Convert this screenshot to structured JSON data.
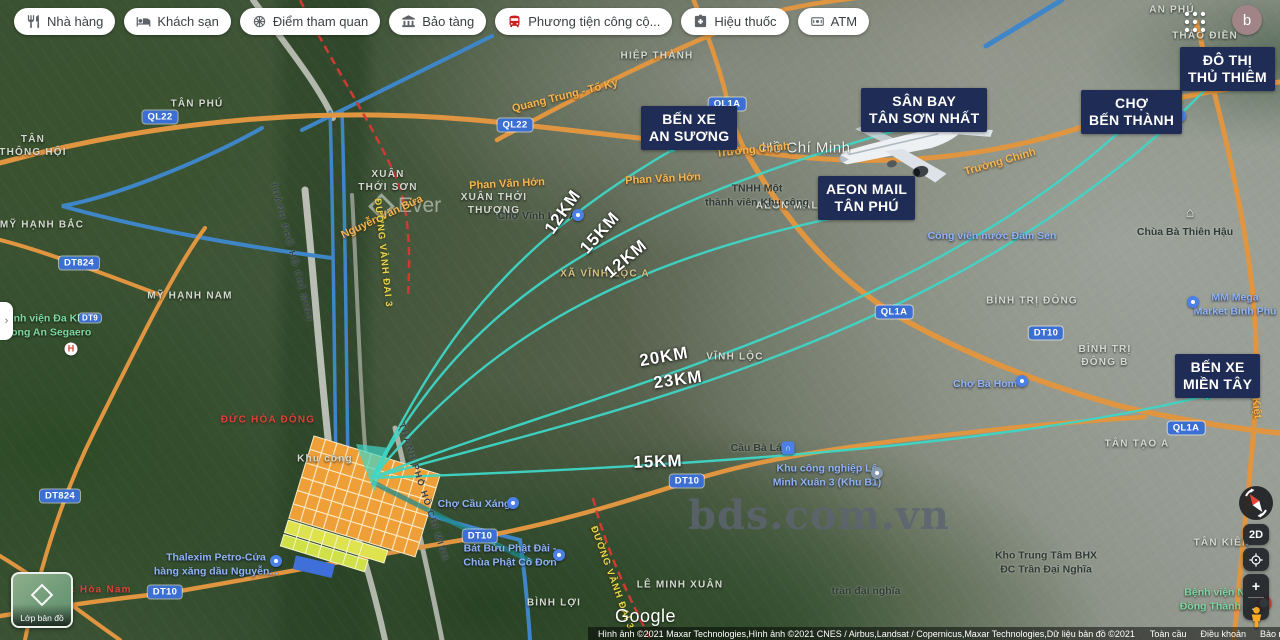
{
  "toolbar": {
    "buttons": [
      {
        "name": "filter-restaurants",
        "icon": "restaurant",
        "label": "Nhà hàng"
      },
      {
        "name": "filter-hotels",
        "icon": "hotel",
        "label": "Khách sạn"
      },
      {
        "name": "filter-attractions",
        "icon": "attraction",
        "label": "Điểm tham quan"
      },
      {
        "name": "filter-museums",
        "icon": "museum",
        "label": "Bảo tàng"
      },
      {
        "name": "filter-transit",
        "icon": "transit",
        "label": "Phương tiện công cộ..."
      },
      {
        "name": "filter-pharmacies",
        "icon": "pharmacy",
        "label": "Hiệu thuốc"
      },
      {
        "name": "filter-atms",
        "icon": "atm",
        "label": "ATM"
      }
    ]
  },
  "header": {
    "avatar_letter": "b"
  },
  "landmarks": [
    {
      "name": "landmark-ben-xe-an-suong",
      "lines": [
        "BẾN XE",
        "AN SƯƠNG"
      ],
      "x": 641,
      "y": 106
    },
    {
      "name": "landmark-san-bay-tan-son-nhat",
      "lines": [
        "SÂN BAY",
        "TÂN SƠN NHẤT"
      ],
      "x": 861,
      "y": 88
    },
    {
      "name": "landmark-aeon-mail-tan-phu",
      "lines": [
        "AEON MAIL",
        "TÂN PHÚ"
      ],
      "x": 818,
      "y": 176
    },
    {
      "name": "landmark-cho-ben-thanh",
      "lines": [
        "CHỢ",
        "BẾN THÀNH"
      ],
      "x": 1081,
      "y": 90
    },
    {
      "name": "landmark-do-thi-thu-thiem",
      "lines": [
        "ĐÔ THỊ",
        "THỦ THIÊM"
      ],
      "x": 1180,
      "y": 47
    },
    {
      "name": "landmark-ben-xe-mien-tay",
      "lines": [
        "BẾN XE",
        "MIỀN TÂY"
      ],
      "x": 1175,
      "y": 354
    }
  ],
  "distance_labels": [
    {
      "text": "12KM",
      "x": 563,
      "y": 212,
      "rot": -55
    },
    {
      "text": "15KM",
      "x": 600,
      "y": 233,
      "rot": -48
    },
    {
      "text": "12KM",
      "x": 626,
      "y": 259,
      "rot": -40
    },
    {
      "text": "20KM",
      "x": 664,
      "y": 357,
      "rot": -10
    },
    {
      "text": "23KM",
      "x": 678,
      "y": 380,
      "rot": -8
    },
    {
      "text": "15KM",
      "x": 658,
      "y": 462,
      "rot": -2
    }
  ],
  "road_badges": [
    {
      "text": "QL22",
      "x": 160,
      "y": 117
    },
    {
      "text": "QL22",
      "x": 515,
      "y": 125
    },
    {
      "text": "QL1A",
      "x": 727,
      "y": 104
    },
    {
      "text": "QL1A",
      "x": 894,
      "y": 312
    },
    {
      "text": "QL1A",
      "x": 1186,
      "y": 428
    },
    {
      "text": "DT824",
      "x": 79,
      "y": 263
    },
    {
      "text": "DT824",
      "x": 60,
      "y": 496
    },
    {
      "text": "DT9",
      "x": 90,
      "y": 318,
      "small": true
    },
    {
      "text": "DT10",
      "x": 1046,
      "y": 333
    },
    {
      "text": "DT10",
      "x": 480,
      "y": 536
    },
    {
      "text": "DT10",
      "x": 687,
      "y": 481
    },
    {
      "text": "DT10",
      "x": 165,
      "y": 592
    }
  ],
  "road_names": [
    {
      "text": "Quang Trung - Tố Ký",
      "x": 565,
      "y": 96,
      "rot": -14,
      "style": "orange"
    },
    {
      "text": "Trường Chinh",
      "x": 753,
      "y": 150,
      "rot": -6,
      "style": "orange"
    },
    {
      "text": "Trường Chinh",
      "x": 1000,
      "y": 162,
      "rot": -16,
      "style": "orange"
    },
    {
      "text": "Phan Văn Hớn",
      "x": 507,
      "y": 184,
      "rot": -3,
      "style": "orange"
    },
    {
      "text": "Phan Văn Hớn",
      "x": 663,
      "y": 179,
      "rot": -3,
      "style": "orange"
    },
    {
      "text": "Nguyễn Văn Bứa",
      "x": 382,
      "y": 217,
      "rot": -25,
      "style": "orange"
    },
    {
      "text": "Võ Văn Kiệt",
      "x": 1254,
      "y": 388,
      "rot": 83,
      "style": "orange"
    },
    {
      "text": "ĐƯỜNG VÀNH ĐAI 3",
      "x": 383,
      "y": 253,
      "rot": 84,
      "style": "yellow"
    },
    {
      "text": "ĐƯỜNG VÀNH ĐAI 3",
      "x": 612,
      "y": 578,
      "rot": 70,
      "style": "yellow"
    },
    {
      "text": "THÀNH PHỐ HỒ CHÍ MINH",
      "x": 292,
      "y": 252,
      "rot": 75,
      "style": "darkroad"
    },
    {
      "text": "THÀNH PHỐ HỒ CHÍ MINH",
      "x": 424,
      "y": 492,
      "rot": 72,
      "style": "darkroad"
    }
  ],
  "area_labels": [
    {
      "lines": [
        "TÂN",
        "THÔNG HỘI"
      ],
      "x": 33,
      "y": 146
    },
    {
      "lines": [
        "TÂN PHÚ"
      ],
      "x": 197,
      "y": 104
    },
    {
      "lines": [
        "MỸ HẠNH BẮC"
      ],
      "x": 42,
      "y": 225
    },
    {
      "lines": [
        "MỸ HẠNH NAM"
      ],
      "x": 190,
      "y": 296
    },
    {
      "lines": [
        "XUÂN",
        "THỚI SƠN"
      ],
      "x": 388,
      "y": 181
    },
    {
      "lines": [
        "XUÂN THỚI",
        "THƯỢNG"
      ],
      "x": 494,
      "y": 204
    },
    {
      "lines": [
        "HIỆP THÀNH"
      ],
      "x": 657,
      "y": 56
    },
    {
      "lines": [
        "THẢO ĐIỀN"
      ],
      "x": 1205,
      "y": 36
    },
    {
      "lines": [
        "AN PHÚ"
      ],
      "x": 1172,
      "y": 10
    },
    {
      "lines": [
        "VĨNH LỘC"
      ],
      "x": 735,
      "y": 357
    },
    {
      "lines": [
        "BÌNH TRỊ ĐÔNG"
      ],
      "x": 1032,
      "y": 301
    },
    {
      "lines": [
        "BÌNH TRỊ",
        "ĐÔNG B"
      ],
      "x": 1105,
      "y": 356
    },
    {
      "lines": [
        "TÂN TẠO A"
      ],
      "x": 1137,
      "y": 444
    },
    {
      "lines": [
        "TÂN KIÊN"
      ],
      "x": 1222,
      "y": 543
    },
    {
      "lines": [
        "LÊ MINH XUÂN"
      ],
      "x": 680,
      "y": 585
    },
    {
      "lines": [
        "BÌNH LỢI"
      ],
      "x": 554,
      "y": 603
    },
    {
      "lines": [
        "XÃ VĨNH LỘC A"
      ],
      "x": 605,
      "y": 274,
      "style": "tan"
    },
    {
      "lines": [
        "AEON MALL"
      ],
      "x": 791,
      "y": 206
    },
    {
      "lines": [
        "Khu công"
      ],
      "x": 325,
      "y": 459
    },
    {
      "lines": [
        "ĐỨC HÒA ĐÔNG"
      ],
      "x": 268,
      "y": 420,
      "style": "red"
    },
    {
      "lines": [
        "Đức Hòa Nam"
      ],
      "x": 92,
      "y": 590,
      "style": "red"
    },
    {
      "lines": [
        "Hồ Chí Minh"
      ],
      "x": 806,
      "y": 148,
      "style": "big"
    }
  ],
  "poi_labels": [
    {
      "name": "poi-benh-vien-long-an",
      "lines": [
        "Bệnh viện Đa Khoa",
        "Long An Segaero"
      ],
      "x": 48,
      "y": 326,
      "color": "green",
      "pin": {
        "type": "hospital",
        "x": 71,
        "y": 349
      }
    },
    {
      "name": "poi-cho-vinh-loc-a",
      "lines": [
        "Chợ Vĩnh Lộc A"
      ],
      "x": 537,
      "y": 217,
      "color": "dark",
      "pin": {
        "type": "cart",
        "x": 578,
        "y": 215
      }
    },
    {
      "name": "poi-cho-cau-xang",
      "lines": [
        "Chợ Cầu Xáng"
      ],
      "x": 474,
      "y": 505,
      "color": "blue",
      "pin": {
        "type": "cart",
        "x": 513,
        "y": 503
      }
    },
    {
      "name": "poi-thalexim-petro",
      "lines": [
        "Thalexim Petro-Cửa",
        "hàng xăng dầu Nguyễn..."
      ],
      "x": 216,
      "y": 565,
      "color": "blue",
      "pin": {
        "type": "gas",
        "x": 276,
        "y": 561
      }
    },
    {
      "name": "poi-bat-buu-phat-dai",
      "lines": [
        "Bát Bửu Phật Đài -",
        "Chùa Phật Cô Đơn"
      ],
      "x": 510,
      "y": 556,
      "color": "blue",
      "pin": {
        "type": "dot",
        "x": 559,
        "y": 555
      }
    },
    {
      "name": "poi-kcn-le-minh-xuan",
      "lines": [
        "Khu công nghiệp Lê",
        "Minh Xuân 3 (Khu B1)"
      ],
      "x": 827,
      "y": 476,
      "color": "blue",
      "pin": {
        "type": "gray",
        "x": 877,
        "y": 473
      }
    },
    {
      "name": "poi-cau-ba-lat",
      "lines": [
        "Cầu Bà Lát"
      ],
      "x": 758,
      "y": 449,
      "color": "dark",
      "pin": {
        "type": "bridge",
        "x": 788,
        "y": 448
      }
    },
    {
      "name": "poi-dam-sen",
      "lines": [
        "Công viên nước Đầm Sen"
      ],
      "x": 992,
      "y": 237,
      "color": "blue"
    },
    {
      "name": "poi-chua-ba-thien-hau",
      "lines": [
        "Chùa Bà Thiên Hậu"
      ],
      "x": 1185,
      "y": 233,
      "color": "dark",
      "pin": {
        "type": "temple",
        "x": 1190,
        "y": 212
      }
    },
    {
      "name": "poi-mm-mega-market",
      "lines": [
        "MM Mega",
        "Market Bình Phú"
      ],
      "x": 1235,
      "y": 305,
      "color": "blue",
      "pin": {
        "type": "cart",
        "x": 1193,
        "y": 302
      }
    },
    {
      "name": "poi-cho-ba-hom",
      "lines": [
        "Chợ Bà Hom"
      ],
      "x": 985,
      "y": 385,
      "color": "blue",
      "pin": {
        "type": "cart",
        "x": 1022,
        "y": 381
      }
    },
    {
      "name": "poi-kho-trung-tam",
      "lines": [
        "Kho Trung Tâm BHX",
        "ĐC Trần Đại Nghĩa"
      ],
      "x": 1046,
      "y": 563,
      "color": "dark"
    },
    {
      "name": "poi-tran-dai-nghia",
      "lines": [
        "trần đại nghĩa"
      ],
      "x": 866,
      "y": 592,
      "color": "dark"
    },
    {
      "name": "poi-benh-vien-nhi",
      "lines": [
        "Bệnh viện N...",
        "Đồng Thành P..."
      ],
      "x": 1219,
      "y": 600,
      "color": "green",
      "pin": {
        "type": "redpin",
        "x": 1264,
        "y": 603
      }
    },
    {
      "name": "poi-tnhh-khu-cong",
      "lines": [
        "TNHH Một",
        "thành viên Khu công"
      ],
      "x": 757,
      "y": 196,
      "color": "dark"
    },
    {
      "name": "poi-ben-thanh-fragment",
      "lines": [
        "ành"
      ],
      "x": 1163,
      "y": 116,
      "color": "light",
      "pin": {
        "type": "dot",
        "x": 1180,
        "y": 116
      }
    }
  ],
  "watermarks": {
    "site": "bds.com.vn",
    "map": "Ever"
  },
  "map_controls": {
    "twod": "2D",
    "layers_label": "Lớp bản đồ"
  },
  "attribution": {
    "copyright": "Hình ảnh ©2021 Maxar Technologies,Hình ảnh ©2021 CNES / Airbus,Landsat / Copernicus,Maxar Technologies,Dữ liệu bản đồ ©2021",
    "links": [
      "Toàn cầu",
      "Điều khoản",
      "Bảo mật",
      "Gửi phản hồi"
    ],
    "scale": "1 ki lô mét"
  },
  "google_logo": "Google",
  "colors": {
    "line_cyan": "#3fd6c6",
    "landmark_bg": "#1f2c55",
    "road_orange": "#e09540",
    "badge_blue": "#3b6fd4",
    "estate_orange": "#ef9f38"
  }
}
